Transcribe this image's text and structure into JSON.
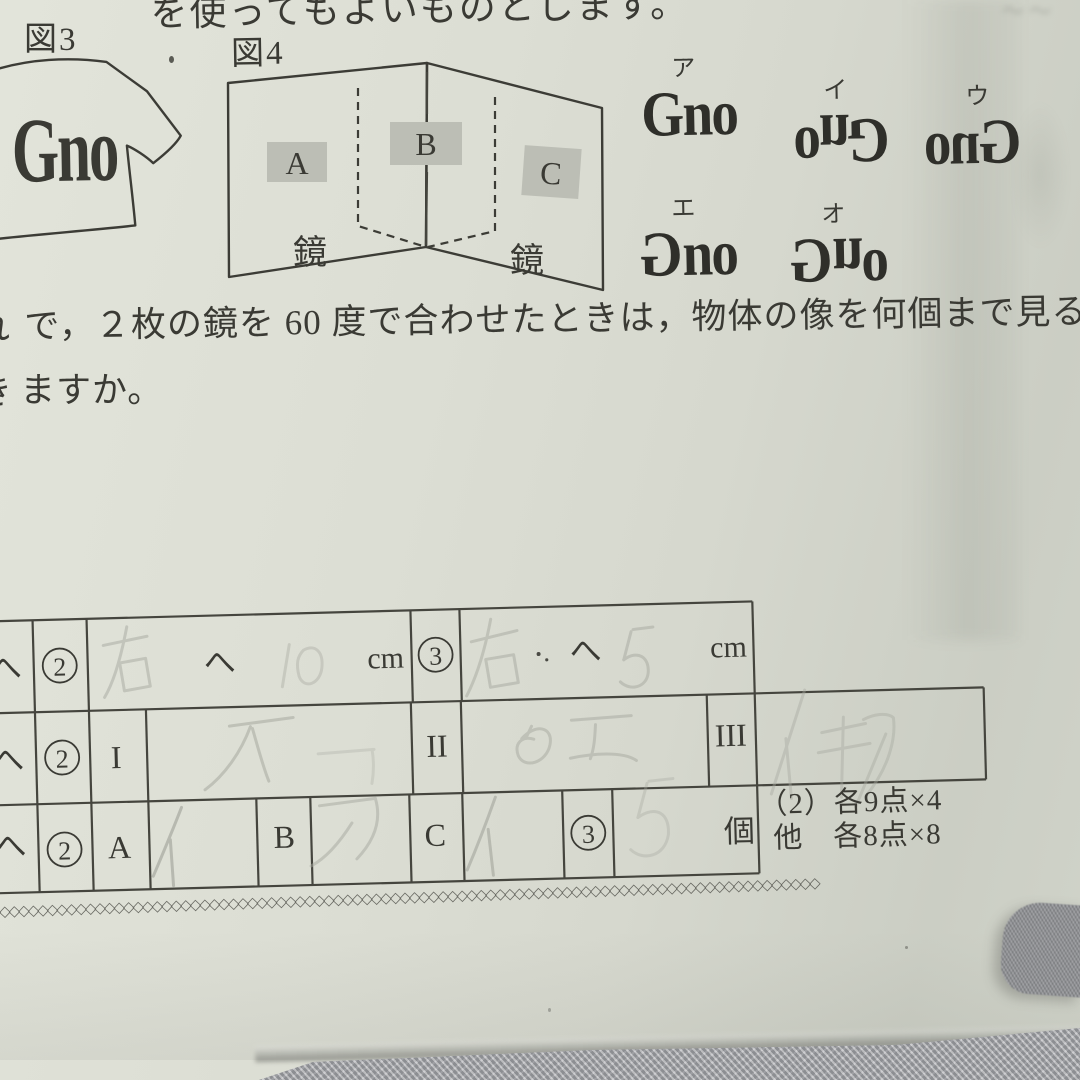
{
  "photo": {
    "paper_color": "#d9dbd1",
    "ink_color": "#3a3a34",
    "pencil_color": "#a7a9a0"
  },
  "top_text": {
    "line": "を使ってもよいものとします。"
  },
  "figure3": {
    "label": "図3",
    "shirt_text": "Gno"
  },
  "figure4": {
    "label": "図4",
    "box_a": "A",
    "box_b": "B",
    "box_c": "C",
    "mirror_left": "鏡",
    "mirror_right": "鏡"
  },
  "options": [
    {
      "label": "ア",
      "word": "Gno",
      "transform": "normal"
    },
    {
      "label": "イ",
      "char0": "o",
      "char1": "n",
      "char2": "G",
      "transform": "rotated-180"
    },
    {
      "label": "ウ",
      "word": "Gno",
      "transform": "mirrored-left-right"
    },
    {
      "label": "エ",
      "char0": "G",
      "char1": "n",
      "char2": "o",
      "transform": "G-mirrored"
    },
    {
      "label": "オ",
      "char0": "G",
      "char1": "n",
      "char2": "o",
      "transform": "G-mirrored-n-flipped"
    }
  ],
  "question": {
    "fragment1": "れ",
    "line1": "で，２枚の鏡を 60 度で合わせたときは，物体の像を何個まで見ること",
    "fragment2": "き",
    "line2": "ますか。"
  },
  "table": {
    "hen": "へ",
    "cm": "cm",
    "ko": "個",
    "digit2": "2",
    "digit3": "3",
    "rom1": "I",
    "rom2": "II",
    "rom3": "III",
    "A": "A",
    "B": "B",
    "C": "C"
  },
  "handwriting": {
    "row1_slot2": "右 10",
    "row1_slot3": "右 5",
    "row2_I": "オ",
    "row2_I_faint": "エ",
    "row2_II": "ウエ",
    "row2_III": "イキア",
    "row3_A": "イ",
    "row3_B": "ア",
    "row3_C": "イ",
    "row3_slot3": "5"
  },
  "score_note": {
    "line1": "（2）各9点×4",
    "line2": "他　各8点×8"
  },
  "zigzag": {
    "char": "◇",
    "count": 88
  }
}
